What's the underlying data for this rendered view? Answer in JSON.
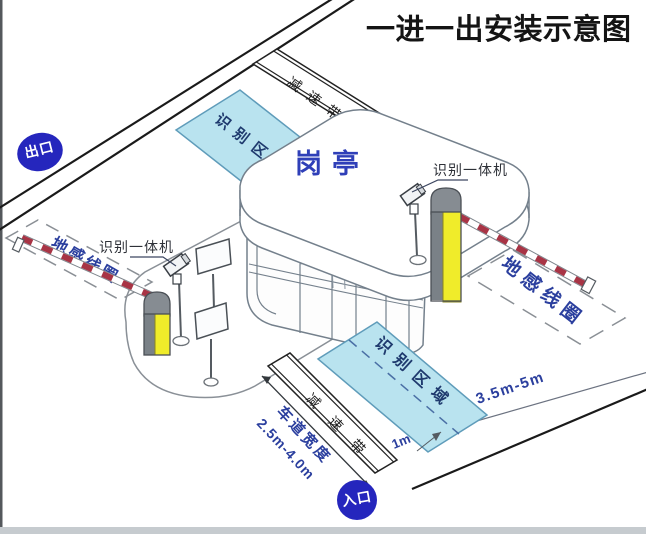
{
  "title": "一进一出安装示意图",
  "badges": {
    "exit": "出口",
    "entrance": "入口"
  },
  "booth": {
    "label": "岗亭"
  },
  "zones": {
    "recognition_top": "识别区域",
    "recognition_bottom": "识别区域",
    "ground_coil_left": "地感线圈",
    "ground_coil_right": "地感线圈"
  },
  "speed_bumps": {
    "top": "减速带",
    "bottom": "减速带"
  },
  "devices": {
    "camera_left": "识别一体机",
    "camera_right": "识别一体机"
  },
  "dimensions": {
    "coil_distance": "3.5m-5m",
    "stop_line_offset": "1m",
    "lane_width_label": "车道宽度",
    "lane_width_value": "2.5m-4.0m"
  },
  "colors": {
    "badge_blue": "#2526bd",
    "zone_fill": "#b9e3ef",
    "zone_stroke": "#5f9cba",
    "zone_text": "#1f3a6e",
    "coil_text": "#2b3f9e",
    "dim_text": "#2b3f9e",
    "barrier_yellow": "#f0ec2a",
    "arm_red": "#a83445",
    "booth_text": "#2f3fb8",
    "line_dark": "#1a1a1a"
  }
}
